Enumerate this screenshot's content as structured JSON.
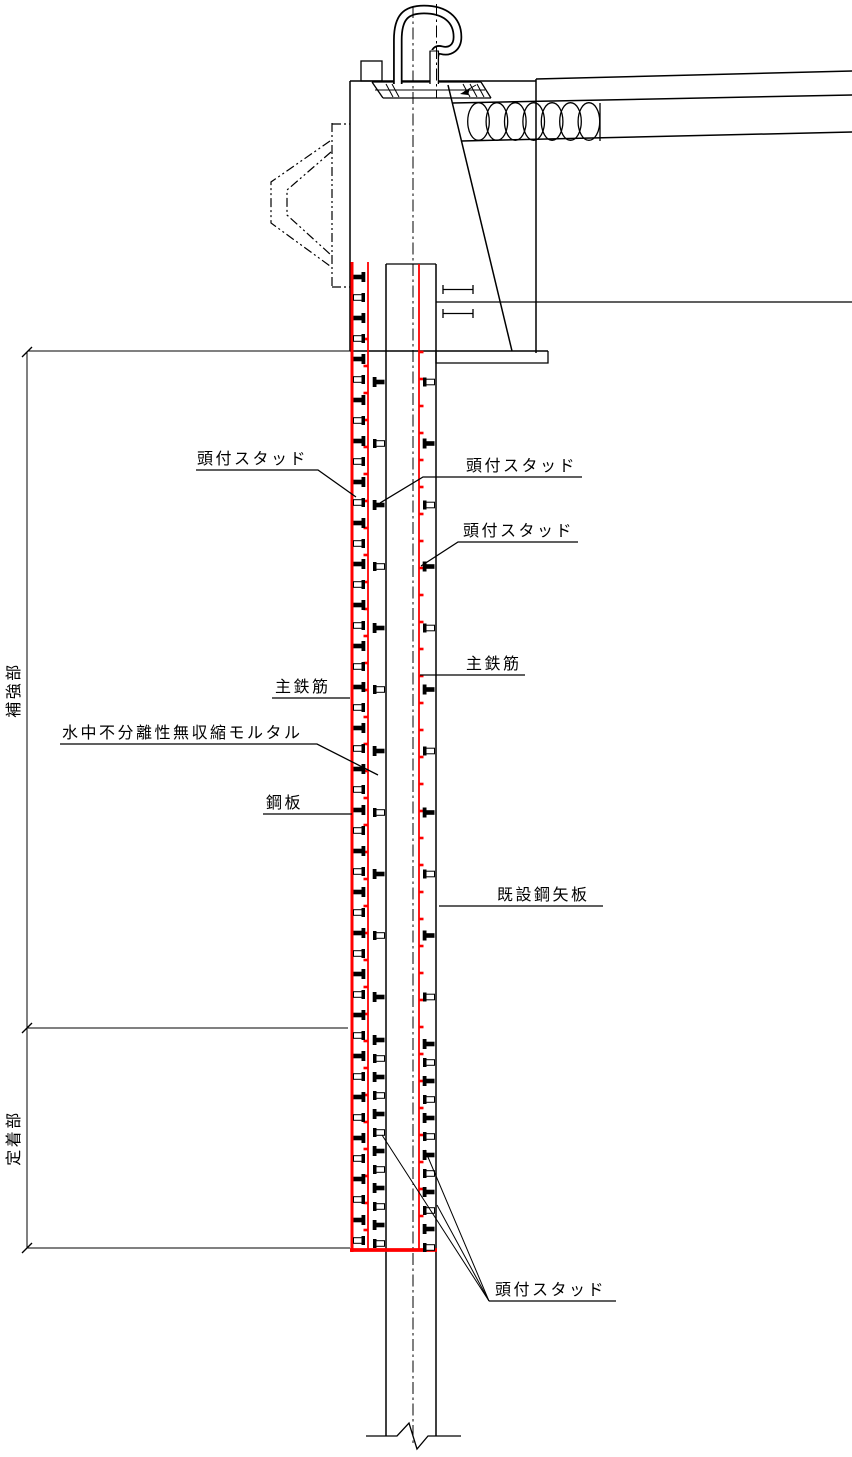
{
  "page": {
    "background": "#ffffff"
  },
  "colors": {
    "accent_red": "#ff0000",
    "line": "#000000"
  },
  "labels": {
    "stud_top_left": "頭付スタッド",
    "stud_top_right": "頭付スタッド",
    "stud_mid_right": "頭付スタッド",
    "stud_bottom": "頭付スタッド",
    "main_rebar_left": "主鉄筋",
    "main_rebar_right": "主鉄筋",
    "mortar": "水中不分離性無収縮モルタル",
    "steel_plate": "鋼板",
    "existing_sheet_pile": "既設鋼矢板",
    "zone_reinforcement": "補強部",
    "zone_anchorage": "定着部"
  }
}
